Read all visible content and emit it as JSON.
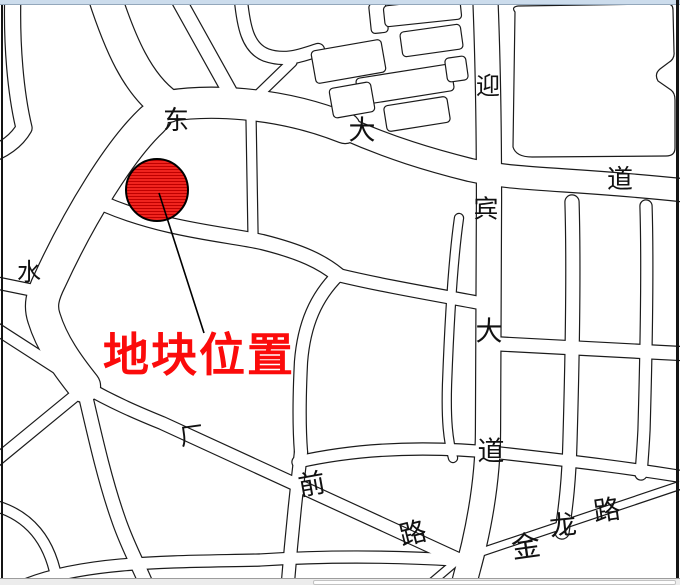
{
  "window": {
    "top_strip_color": "#ccdcec",
    "scrollbar": {
      "track_color": "#ececec",
      "thumb_color": "#fdfdfd"
    }
  },
  "map": {
    "style": {
      "background": "#ffffff",
      "casing_color": "#1b1b1b",
      "road_fill": "#ffffff",
      "label_color": "#111111"
    },
    "marker": {
      "label": "地块位置",
      "label_color": "#fb0b0b",
      "label_pos": {
        "x": 103,
        "y": 333
      },
      "font_size": 46,
      "circle": {
        "cx": 157,
        "cy": 190,
        "r": 31,
        "fill": "#f3251f",
        "hatch": "#bf0000",
        "stroke": "#000000"
      },
      "leader": {
        "x1": 159,
        "y1": 193,
        "x2": 204,
        "y2": 333
      }
    },
    "labels": [
      {
        "t": "东",
        "x": 176,
        "y": 121,
        "s": 26,
        "r": 0
      },
      {
        "t": "大",
        "x": 362,
        "y": 131,
        "s": 27,
        "r": 0
      },
      {
        "t": "道",
        "x": 620,
        "y": 180,
        "s": 26,
        "r": 0
      },
      {
        "t": "迎",
        "x": 488,
        "y": 87,
        "s": 24,
        "r": 0
      },
      {
        "t": "宾",
        "x": 486,
        "y": 210,
        "s": 25,
        "r": 0
      },
      {
        "t": "大",
        "x": 489,
        "y": 332,
        "s": 27,
        "r": 0
      },
      {
        "t": "道",
        "x": 491,
        "y": 452,
        "s": 27,
        "r": 0
      },
      {
        "t": "水",
        "x": 29,
        "y": 273,
        "s": 24,
        "r": 0
      },
      {
        "t": "厂",
        "x": 192,
        "y": 437,
        "s": 24,
        "r": -8
      },
      {
        "t": "前",
        "x": 312,
        "y": 485,
        "s": 27,
        "r": -10
      },
      {
        "t": "路",
        "x": 413,
        "y": 534,
        "s": 27,
        "r": -14
      },
      {
        "t": "金",
        "x": 526,
        "y": 548,
        "s": 29,
        "r": -8
      },
      {
        "t": "龙",
        "x": 563,
        "y": 526,
        "s": 27,
        "r": -6
      },
      {
        "t": "路",
        "x": 607,
        "y": 511,
        "s": 27,
        "r": -8
      }
    ],
    "roads": [
      {
        "id": "avenue-west",
        "d": "M 102,-12 C 120,45 138,85 168,106",
        "w": 32
      },
      {
        "id": "avenue-mid",
        "d": "M 168,106 C 205,100 275,100 345,128",
        "w": 30
      },
      {
        "id": "avenue-east",
        "d": "M 345,128 C 390,148 430,160 470,170 C 520,181 570,178 690,191",
        "w": 22
      },
      {
        "id": "top-nw-diagonal",
        "d": "M 172,-12 L 231,94",
        "w": 14
      },
      {
        "id": "corner-road",
        "d": "M 13,-10 C 11,45 16,95 24,128 C 16,142 2,150 -8,154",
        "w": 15
      },
      {
        "id": "shui-road",
        "d": "M 152,120 C 120,150 80,215 50,280 C 42,296 40,306 44,318 C 52,344 68,366 84,386",
        "w": 32
      },
      {
        "id": "west-stub",
        "d": "M -8,282 L 46,293",
        "w": 11
      },
      {
        "id": "wnw-road",
        "d": "M -8,326 L 82,384",
        "w": 11
      },
      {
        "id": "sw-road",
        "d": "M -8,464 L 82,390",
        "w": 11
      },
      {
        "id": "south-curve",
        "d": "M 83,385 C 94,432 104,478 118,518 C 127,545 138,564 147,586",
        "w": 13
      },
      {
        "id": "changqian-road",
        "d": "M 84,386 C 112,402 135,412 162,423 L 458,559",
        "w": 12
      },
      {
        "id": "jinlong-road",
        "d": "M 418,594 L 458,560 L 690,482",
        "w": 7
      },
      {
        "id": "bottom-road",
        "d": "M 28,584 C 90,560 180,562 260,560 C 340,555 405,557 455,560",
        "w": 11
      },
      {
        "id": "mid-road",
        "d": "M 104,204 C 165,230 225,234 262,242 C 302,252 322,262 338,275",
        "w": 14
      },
      {
        "id": "ese-branch",
        "d": "M 338,275 C 375,284 420,292 480,303",
        "w": 12
      },
      {
        "id": "south-branch",
        "d": "M 338,275 C 316,297 304,324 301,362 C 299,402 299,427 301,452",
        "w": 12
      },
      {
        "id": "south-branch-2",
        "d": "M 301,452 C 296,494 291,542 287,594",
        "w": 12
      },
      {
        "id": "n-connector",
        "d": "M 251,116 L 253,234",
        "w": 9
      },
      {
        "id": "yingbin-avenue",
        "d": "M 485,-10 C 488,60 489,130 489,200 C 489,290 488,360 488,430 C 488,470 482,510 474,545 C 470,562 466,575 462,592",
        "w": 24
      },
      {
        "id": "top-stub",
        "d": "M 240,-10 C 243,28 248,48 266,55 C 286,62 302,55 318,50",
        "w": 12
      },
      {
        "id": "stub-connector",
        "d": "M 258,95 L 292,62",
        "w": 9
      },
      {
        "id": "narrow-parallel",
        "d": "M 459,218 C 453,260 449,330 447,385 C 446,420 448,440 453,458",
        "w": 8
      },
      {
        "id": "grid-vert-1",
        "d": "M 572,202 C 574,270 572,370 570,440 C 569,480 566,505 562,532",
        "w": 13
      },
      {
        "id": "grid-vert-2",
        "d": "M 646,206 C 648,270 646,360 644,430 C 643,450 642,462 641,474",
        "w": 11
      },
      {
        "id": "grid-horiz-1",
        "d": "M 500,344 L 690,354",
        "w": 13
      },
      {
        "id": "grid-horiz-2",
        "d": "M 298,462 C 360,448 430,446 500,453 C 580,462 630,468 690,478",
        "w": 11
      },
      {
        "id": "sw-bottom-road",
        "d": "M -8,505 C 28,514 52,540 58,588",
        "w": 10
      }
    ],
    "blocks": [
      {
        "x": 370,
        "y": 3,
        "w": 17,
        "h": 30,
        "r": -6
      },
      {
        "x": 384,
        "y": 2,
        "w": 77,
        "h": 21,
        "r": -6
      },
      {
        "x": 401,
        "y": 28,
        "w": 61,
        "h": 25,
        "r": -8
      },
      {
        "x": 313,
        "y": 45,
        "w": 71,
        "h": 33,
        "r": -10
      },
      {
        "x": 357,
        "y": 71,
        "w": 96,
        "h": 27,
        "r": -9
      },
      {
        "x": 446,
        "y": 57,
        "w": 21,
        "h": 24,
        "r": -8
      },
      {
        "x": 331,
        "y": 85,
        "w": 42,
        "h": 30,
        "r": -10
      },
      {
        "x": 385,
        "y": 101,
        "w": 64,
        "h": 26,
        "r": -9
      }
    ],
    "big_block": "M 515,12 Q 511,7 518,6 L 658,4 L 668,4 Q 673,4 673,10 L 674,52 Q 675,59 668,63 L 660,69 Q 654,74 658,81 L 671,90 Q 675,93 675,100 L 675,148 Q 675,156 666,156 L 532,157 Q 516,157 513,147 Z"
  }
}
